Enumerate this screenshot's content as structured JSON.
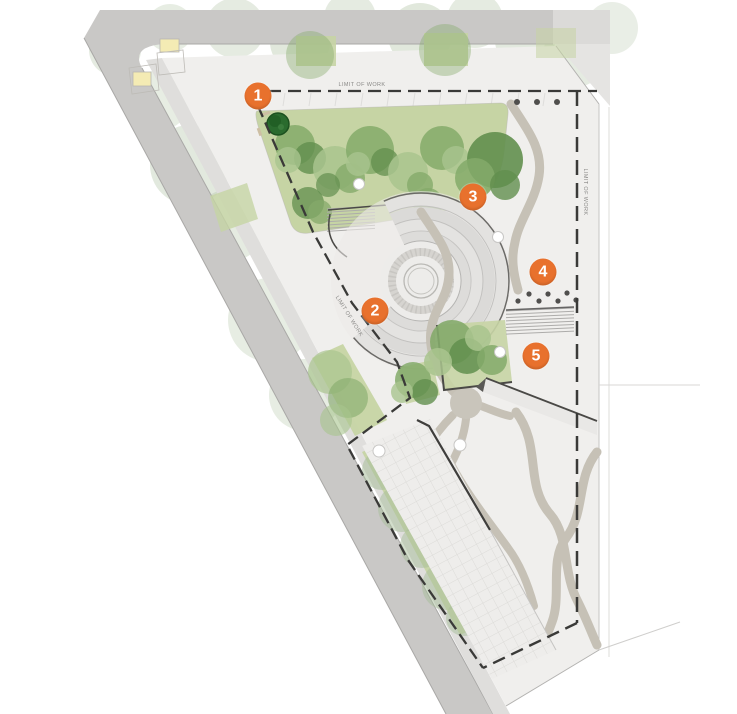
{
  "plan": {
    "boundary_label": "LIMIT OF WORK",
    "markers": [
      {
        "label": "1",
        "x": 258,
        "y": 96
      },
      {
        "label": "2",
        "x": 375,
        "y": 311
      },
      {
        "label": "3",
        "x": 473,
        "y": 197
      },
      {
        "label": "4",
        "x": 543,
        "y": 272
      },
      {
        "label": "5",
        "x": 536,
        "y": 356
      }
    ],
    "colors": {
      "marker_fill": "#e8712d",
      "marker_text": "#ffffff",
      "road": "#c9c8c6",
      "road_edge": "#a9a8a6",
      "sidewalk": "#dfdedc",
      "ground": "#f0efed",
      "lawn": "#c6d4a4",
      "tree_light": "#a9c48e",
      "tree_mid": "#84aa6a",
      "tree_dark": "#628f4e",
      "tree_faded": "#a8bd9a",
      "evergreen": "#2a6b2e",
      "path": "#c6c1b6",
      "wall": "#4a4946",
      "dash": "#3a3a38",
      "building": "#f4ebb4",
      "label_text": "#8a8987",
      "band_light": "#e3e2e0",
      "band_dark": "#dbdad8"
    }
  }
}
